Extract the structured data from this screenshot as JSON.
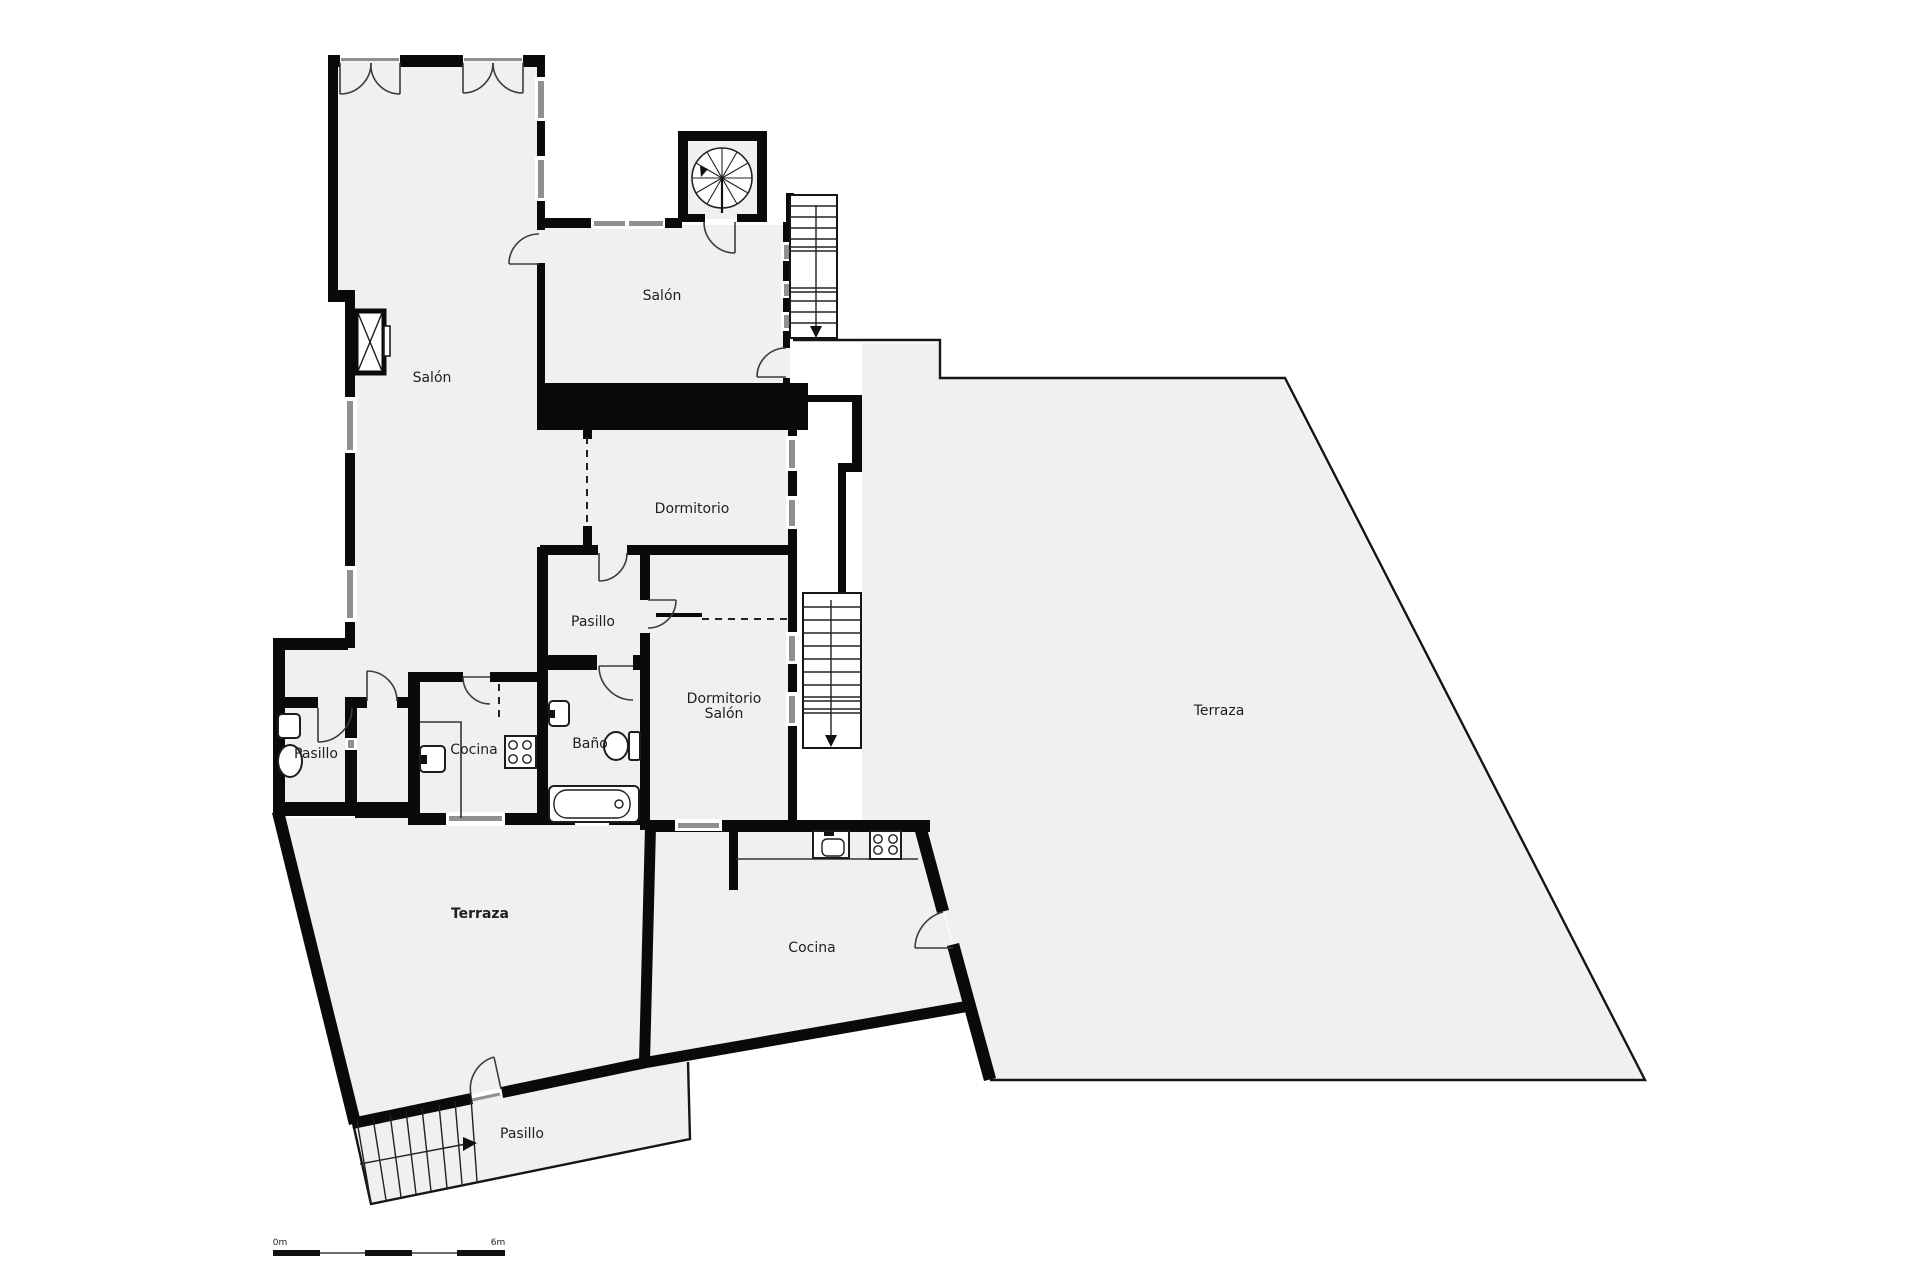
{
  "document": {
    "type": "floor-plan"
  },
  "labels": {
    "salon_main": "Salón",
    "salon_upper": "Salón",
    "dormitorio": "Dormitorio",
    "pasillo_mid": "Pasillo",
    "dormitorio_salon_line1": "Dormitorio",
    "dormitorio_salon_line2": "Salón",
    "pasillo_wc": "Pasillo",
    "cocina": "Cocina",
    "bano": "Baño",
    "terraza_lower": "Terraza",
    "cocina_lower": "Cocina",
    "terraza_main": "Terraza",
    "pasillo_entry": "Pasillo",
    "scale_start": "0m",
    "scale_end": "6m"
  },
  "colors": {
    "background": "#ffffff",
    "wall": "#0a0a0a",
    "room_fill": "#f0f0f1",
    "window": "#909090",
    "door_arc": "#3c3c3c",
    "text": "#1f1f1f"
  }
}
